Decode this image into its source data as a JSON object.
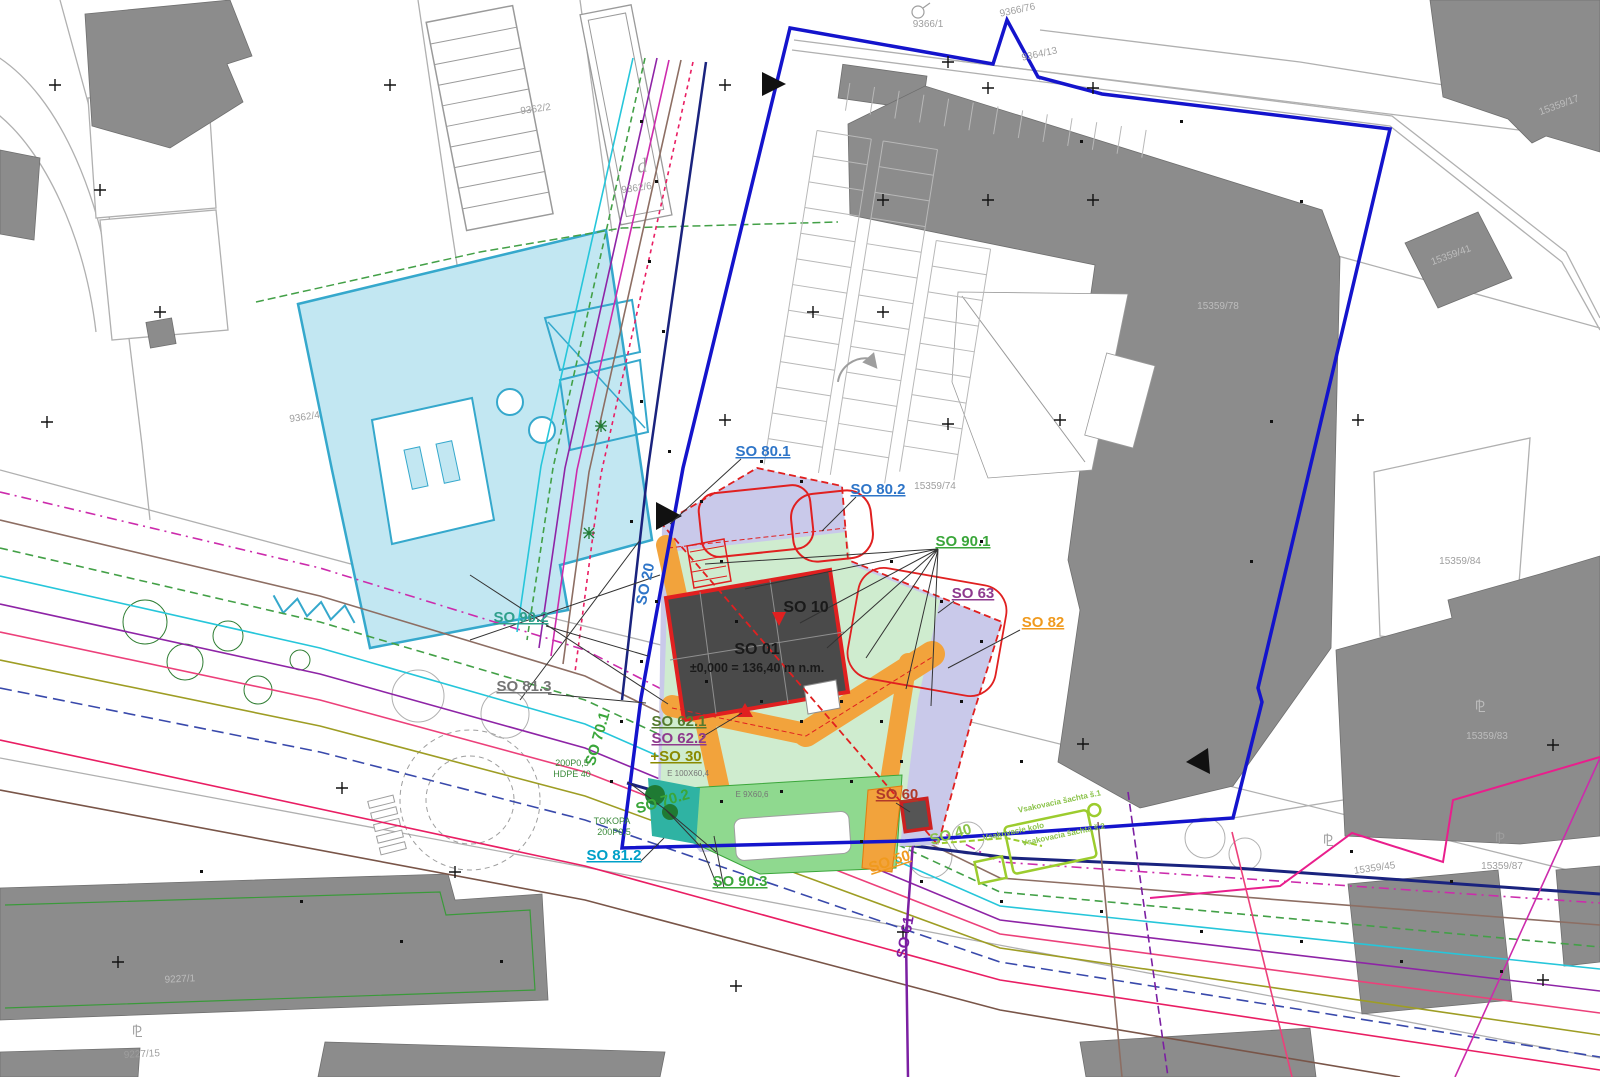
{
  "labels": {
    "so801": "SO 80.1",
    "so802": "SO 80.2",
    "so901": "SO 90.1",
    "so902": "SO 90.2",
    "so903": "SO 90.3",
    "so63": "SO 63",
    "so10": "SO 10",
    "so82": "SO 82",
    "so01": "SO 01",
    "so01_level": "±0,000 = 136,40 m n.m.",
    "so621": "SO 62.1",
    "so622": "SO 62.2",
    "so30": "+SO 30",
    "so60": "SO 60",
    "so50": "SO 50",
    "so61": "SO 61",
    "so40": "SO 40",
    "so701": "SO 70.1",
    "so702": "SO 70.2",
    "so812": "SO 81.2",
    "so813": "SO 81.3",
    "so20": "SO 20"
  },
  "parcels": {
    "p9362_2": "9362/2",
    "p9362_4": "9362/4",
    "p9362_6": "9362/6",
    "d": "d",
    "p9366_1": "9366/1",
    "p9366_76": "9366/76",
    "p9364_13": "9364/13",
    "p15359_17": "15359/17",
    "p15359_41": "15359/41",
    "p15359_74": "15359/74",
    "p15359_78": "15359/78",
    "p15359_83": "15359/83",
    "p15359_84": "15359/84",
    "p15359_45": "15359/45",
    "p15359_87": "15359/87",
    "p9227_1": "9227/1",
    "p9227_15": "9227/15"
  },
  "notes": {
    "pipe1a": "200P0,5",
    "pipe1b": "HDPE 40",
    "pipe2a": "TOKOPA",
    "pipe2b": "200P0,5",
    "e1": "E 100X60,4",
    "e2": "E 9X60,6",
    "vsak1": "Vsakovacia šachta š.1",
    "vsak2": "Vsakovacie kolo",
    "vsak3": "Vsakovacia šachta š.2",
    "survey_glyph": "⅊"
  },
  "palette": {
    "blue": "#2e75c8",
    "green": "#3aa63a",
    "teal": "#2fa08c",
    "purple": "#8e3a8e",
    "violet": "#7b1fa2",
    "orange": "#f09a1e",
    "olive": "#8a8a00",
    "dkgreen": "#557a2f",
    "redbrown": "#b03a2a",
    "lime": "#8bc34a",
    "cyan": "#00a0c8",
    "gray": "#757575",
    "dark": "#1a1a1a",
    "parcel": "#9e9e9e",
    "parcelOnGray": "#bdbdbd",
    "note": "#3a8a3a"
  },
  "colors": {
    "boundary": "#1414cc",
    "proposed_outline": "#e02020",
    "zone_lavender": "#c9c9ea",
    "zone_green": "#cfeccf",
    "zone_orange": "#f2a33c",
    "zone_bright_green": "#8fd98f",
    "zone_teal": "#2fb3a3",
    "building_existing": "#8c8c8c",
    "building_proposed_dark": "#4a4a4a",
    "cyan_fill": "#c2e7f2",
    "cyan_stroke": "#35a8cc"
  }
}
